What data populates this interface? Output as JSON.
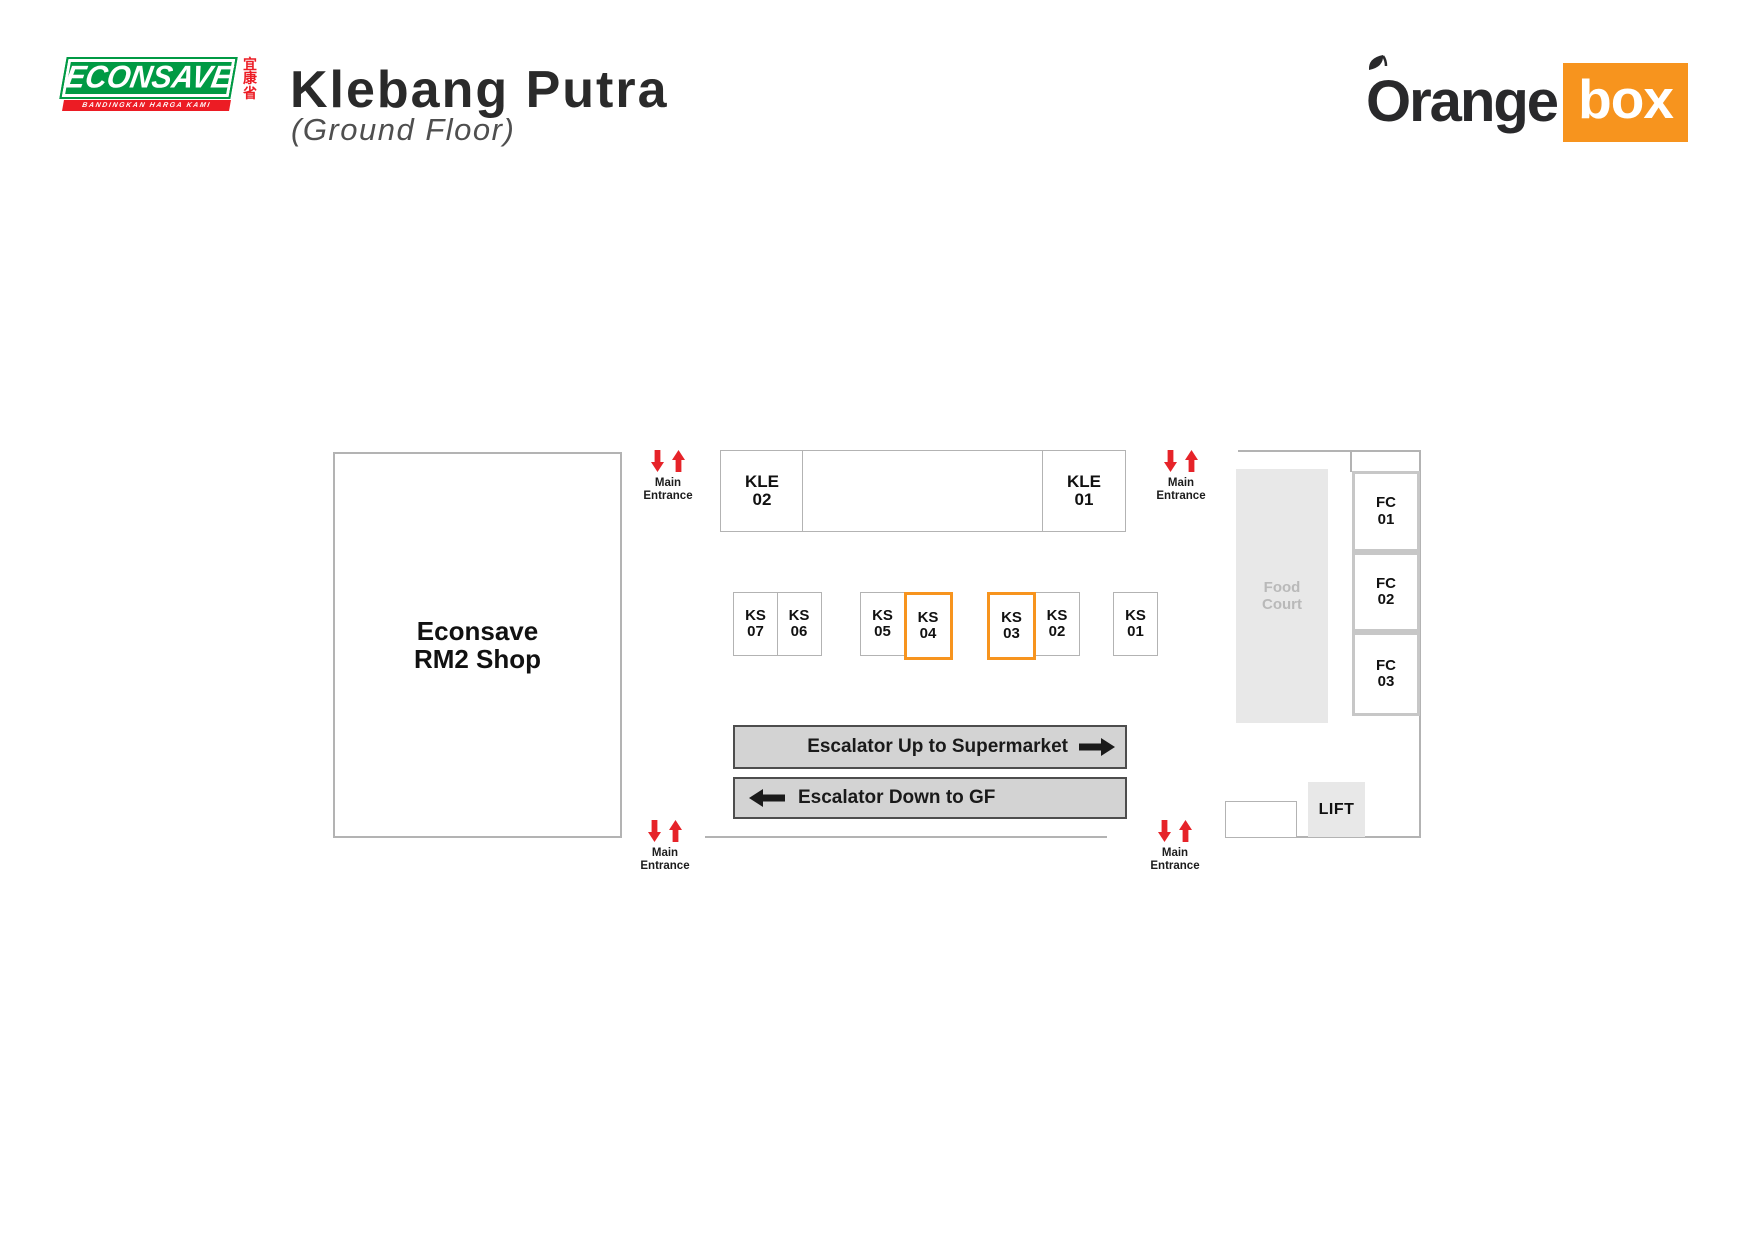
{
  "header": {
    "econsave": {
      "wordmark": "ECONSAVE",
      "tagline": "BANDINGKAN HARGA KAMI",
      "chinese_chars": "宜康省",
      "green": "#009A44",
      "red": "#EC1C24"
    },
    "title": "Klebang Putra",
    "subtitle": "(Ground Floor)",
    "orangebox": {
      "word_orange": "Orange",
      "word_box": "box",
      "orange": "#F7941E"
    }
  },
  "map": {
    "anchor_shop": {
      "line1": "Econsave",
      "line2": "RM2 Shop"
    },
    "kle_units": [
      {
        "code": "KLE",
        "num": "02"
      },
      {
        "code": "KLE",
        "num": "01"
      }
    ],
    "ks_units": [
      {
        "code": "KS",
        "num": "07",
        "highlighted": false
      },
      {
        "code": "KS",
        "num": "06",
        "highlighted": false
      },
      {
        "code": "KS",
        "num": "05",
        "highlighted": false
      },
      {
        "code": "KS",
        "num": "04",
        "highlighted": true
      },
      {
        "code": "KS",
        "num": "03",
        "highlighted": true
      },
      {
        "code": "KS",
        "num": "02",
        "highlighted": false
      },
      {
        "code": "KS",
        "num": "01",
        "highlighted": false
      }
    ],
    "fc_units": [
      {
        "code": "FC",
        "num": "01"
      },
      {
        "code": "FC",
        "num": "02"
      },
      {
        "code": "FC",
        "num": "03"
      }
    ],
    "food_court": {
      "line1": "Food",
      "line2": "Court"
    },
    "lift_label": "LIFT",
    "escalator_up_label": "Escalator Up to Supermarket",
    "escalator_down_label": "Escalator Down to GF",
    "entrance_label": {
      "line1": "Main",
      "line2": "Entrance"
    },
    "colors": {
      "highlight_orange": "#F7941E",
      "entrance_red": "#E62329",
      "wall_gray": "#b3b3b3",
      "escalator_fill": "#d3d3d3",
      "food_court_fill": "#e8e8e8"
    }
  }
}
